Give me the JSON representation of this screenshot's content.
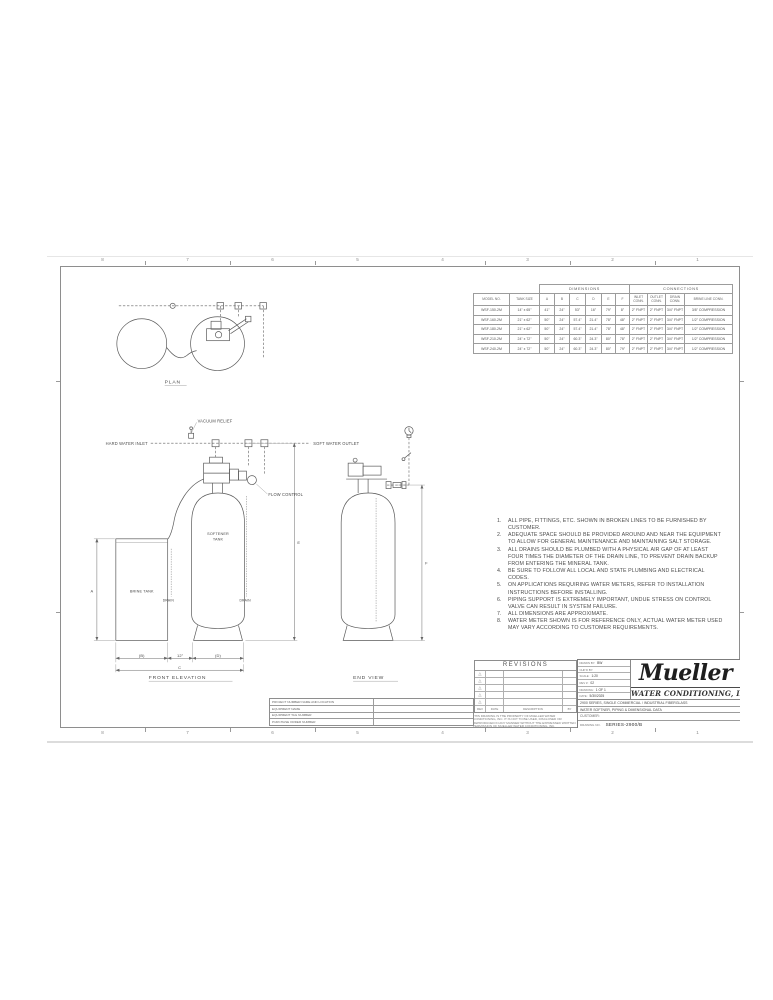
{
  "sheet": {
    "zones_top": [
      "8",
      "7",
      "6",
      "5",
      "4",
      "3",
      "2",
      "1"
    ],
    "zones_bottom": [
      "8",
      "7",
      "6",
      "5",
      "4",
      "3",
      "2",
      "1"
    ]
  },
  "plan": {
    "label": "PLAN"
  },
  "front": {
    "label": "FRONT ELEVATION",
    "vacuum_relief": "VACUUM RELIEF",
    "hard_water_inlet": "HARD WATER INLET",
    "soft_water_outlet": "SOFT WATER OUTLET",
    "flow_control": "FLOW CONTROL",
    "softener_tank_line1": "SOFTENER",
    "softener_tank_line2": "TANK",
    "brine_tank": "BRINE TANK",
    "drain_left": "DRAIN",
    "drain_right": "DRAIN",
    "dim_a": "A",
    "dim_e": "E",
    "dim_b": "(B)",
    "dim_gap": "12\"",
    "dim_d": "(D)",
    "dim_c": "C"
  },
  "end": {
    "label": "END VIEW",
    "dim_f": "F"
  },
  "notes": {
    "items": [
      {
        "num": "1.",
        "text": "ALL PIPE, FITTINGS, ETC. SHOWN IN BROKEN LINES TO BE FURNISHED BY CUSTOMER."
      },
      {
        "num": "2.",
        "text": "ADEQUATE SPACE SHOULD BE PROVIDED AROUND AND NEAR THE EQUIPMENT TO ALLOW FOR GENERAL MAINTENANCE AND MAINTAINING SALT STORAGE."
      },
      {
        "num": "3.",
        "text": "ALL DRAINS SHOULD BE PLUMBED WITH A PHYSICAL AIR GAP OF AT LEAST FOUR TIMES THE DIAMETER OF THE DRAIN LINE, TO PREVENT DRAIN BACKUP FROM ENTERING THE MINERAL TANK."
      },
      {
        "num": "4.",
        "text": "BE SURE TO FOLLOW ALL LOCAL AND STATE PLUMBING AND ELECTRICAL CODES."
      },
      {
        "num": "5.",
        "text": "ON APPLICATIONS REQUIRING WATER METERS, REFER TO INSTALLATION INSTRUCTIONS BEFORE INSTALLING."
      },
      {
        "num": "6.",
        "text": "PIPING SUPPORT IS EXTREMELY IMPORTANT, UNDUE STRESS ON CONTROL VALVE CAN RESULT IN SYSTEM FAILURE."
      },
      {
        "num": "7.",
        "text": "ALL DIMENSIONS ARE APPROXIMATE."
      },
      {
        "num": "8.",
        "text": "WATER METER SHOWN IS FOR REFERENCE ONLY, ACTUAL WATER METER USED MAY VARY ACCORDING TO CUSTOMER REQUIREMENTS."
      }
    ]
  },
  "table": {
    "group_dimensions": "DIMENSIONS",
    "group_connections": "CONNECTIONS",
    "headers": [
      "MODEL NO.",
      "TANK SIZE",
      "A",
      "B",
      "C",
      "D",
      "E",
      "F",
      "INLET CONN.",
      "OUTLET CONN.",
      "DRAIN CONN.",
      "BRINE LINE CONN."
    ],
    "rows": [
      [
        "WSF-150-2M",
        "14\" x 65\"",
        "41\"",
        "24\"",
        "53\"",
        "16\"",
        "79\"",
        "8\"",
        "2\" FNPT",
        "2\" FNPT",
        "3/4\" FNPT",
        "3/8\" COMPRESSION"
      ],
      [
        "WSF-160-2M",
        "21\" x 62\"",
        "50\"",
        "24\"",
        "57.4\"",
        "21.4\"",
        "78\"",
        "48\"",
        "2\" FNPT",
        "2\" FNPT",
        "3/4\" FNPT",
        "1/2\" COMPRESSION"
      ],
      [
        "WSF-180-2M",
        "21\" x 62\"",
        "50\"",
        "24\"",
        "57.4\"",
        "21.4\"",
        "78\"",
        "48\"",
        "2\" FNPT",
        "2\" FNPT",
        "3/4\" FNPT",
        "1/2\" COMPRESSION"
      ],
      [
        "WSF-210-2M",
        "24\" x 72\"",
        "50\"",
        "24\"",
        "60.3\"",
        "24.3\"",
        "80\"",
        "78\"",
        "2\" FNPT",
        "2\" FNPT",
        "3/4\" FNPT",
        "1/2\" COMPRESSION"
      ],
      [
        "WSF-240-2M",
        "24\" x 72\"",
        "50\"",
        "24\"",
        "60.3\"",
        "24.3\"",
        "80\"",
        "79\"",
        "2\" FNPT",
        "2\" FNPT",
        "3/4\" FNPT",
        "1/2\" COMPRESSION"
      ]
    ]
  },
  "revisions": {
    "title": "REVISIONS",
    "footer": [
      "REV",
      "DATE",
      "DESCRIPTION",
      "BY"
    ],
    "proprietary": "THIS DRAWING IS THE PROPERTY OF MUELLER WATER CONDITIONING, INC. IT IS NOT TO BE USED, DISCLOSED OR REPRODUCED IN ANY MANNER WITHOUT THE EXPRESSED WRITTEN PERMISSION OF MUELLER WATER CONDITIONING, INC."
  },
  "project": {
    "rows": [
      "PROJECT NUMBER NAME AND LOCATION",
      "EQUIPMENT NAME",
      "EQUIPMENT TAG NUMBER",
      "PURCHASE ORDER NUMBER"
    ]
  },
  "title_block": {
    "fields": [
      {
        "label": "DRAWN BY:",
        "value": "BW"
      },
      {
        "label": "CHK'D BY:",
        "value": ""
      },
      {
        "label": "SCALE:",
        "value": "1:20"
      },
      {
        "label": "REV #:",
        "value": "02"
      },
      {
        "label": "DRAWING:",
        "value": "1 OF 1"
      },
      {
        "label": "DATE:",
        "value": "5/30/2025"
      }
    ],
    "logo": "Mueller",
    "company": "WATER CONDITIONING, INC.",
    "line1": "2900 SERIES, SINGLE COMMERCIAL / INDUSTRIAL FIBERGLASS",
    "line2": "WATER SOFTNER, PIPING & DIMENSIONAL DATA",
    "customer_label": "CUSTOMER:",
    "drawing_no_label": "DRAWING NO.",
    "drawing_no": "SERIES-2900/B"
  }
}
